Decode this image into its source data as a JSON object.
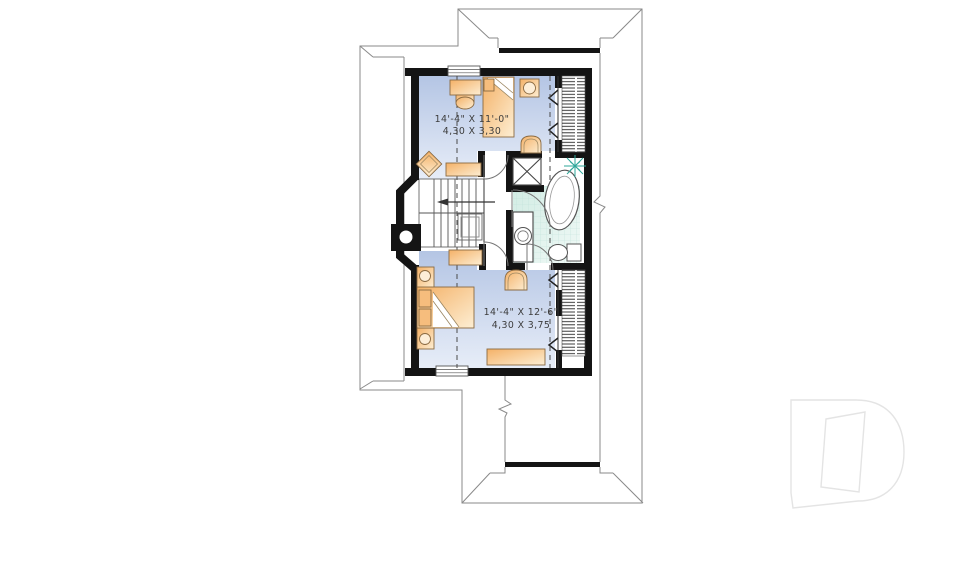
{
  "floor_plan": {
    "rooms": [
      {
        "id": "bedroom-1",
        "dim_imperial": "14'-4\" X 11'-0\"",
        "dim_metric": "4,30 X 3,30"
      },
      {
        "id": "bedroom-2",
        "dim_imperial": "14'-4\" X 12'-6\"",
        "dim_metric": "4,30 X 3,75"
      }
    ],
    "fixtures": [
      "bed",
      "desk",
      "chair",
      "stool",
      "shelf",
      "nightstand",
      "dresser",
      "stairs",
      "bathtub",
      "vanity-sink",
      "toilet",
      "shower",
      "closet-hatch",
      "chimney",
      "window",
      "door-swing",
      "sloped-ceiling-chevron",
      "starburst"
    ]
  },
  "watermark": {
    "letter": "D"
  },
  "colors": {
    "wall": "#141414",
    "roof_line": "#8a8a8a",
    "floor_top": "#b4c5e4",
    "floor_bottom": "#e7edf8",
    "furniture_start": "#f4b167",
    "furniture_end": "#fdeed3",
    "tile": "#d8efe9",
    "tile_grid": "#b9ded6",
    "accent_teal": "#2ea79a",
    "text": "#3c3c3c",
    "watermark": "#e4e4e4"
  }
}
